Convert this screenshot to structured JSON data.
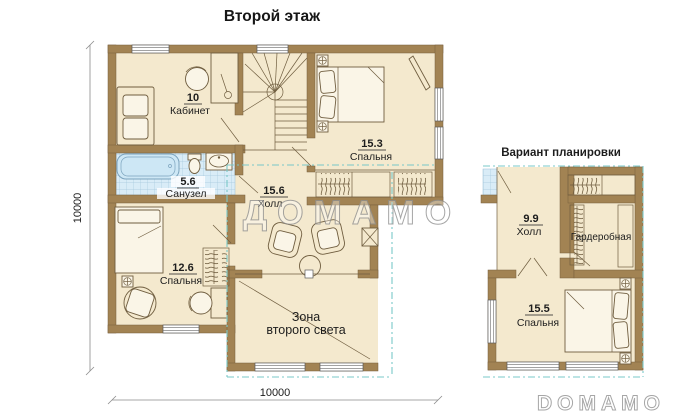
{
  "header": {
    "title": "Второй этаж"
  },
  "main_plan": {
    "watermark": "ДОМАМО",
    "rooms": {
      "office": {
        "area": "10",
        "name": "Кабинет"
      },
      "bedroom_top": {
        "area": "15.3",
        "name": "Спальня"
      },
      "bathroom": {
        "area": "5.6",
        "name": "Санузел"
      },
      "hall": {
        "area": "15.6",
        "name": "Холл"
      },
      "bedroom_left": {
        "area": "12.6",
        "name": "Спальня"
      },
      "light_zone": {
        "line1": "Зона",
        "line2": "второго света"
      }
    },
    "dimensions": {
      "height": "10000",
      "width": "10000"
    }
  },
  "variant_plan": {
    "heading": "Вариант планировки",
    "rooms": {
      "hall": {
        "area": "9.9",
        "name": "Холл"
      },
      "wardrobe": {
        "name": "Гардеробная"
      },
      "bedroom": {
        "area": "15.5",
        "name": "Спальня"
      }
    }
  },
  "footer_watermark": "DOMAMO",
  "colors": {
    "wall": "#a28353",
    "floor": "#f4e9ce",
    "tile": "#d9ecf7",
    "bathtub": "#cde7f5",
    "roof_dashed": "#79c8c8",
    "text": "#1d1d1d",
    "watermark": "#909090"
  }
}
